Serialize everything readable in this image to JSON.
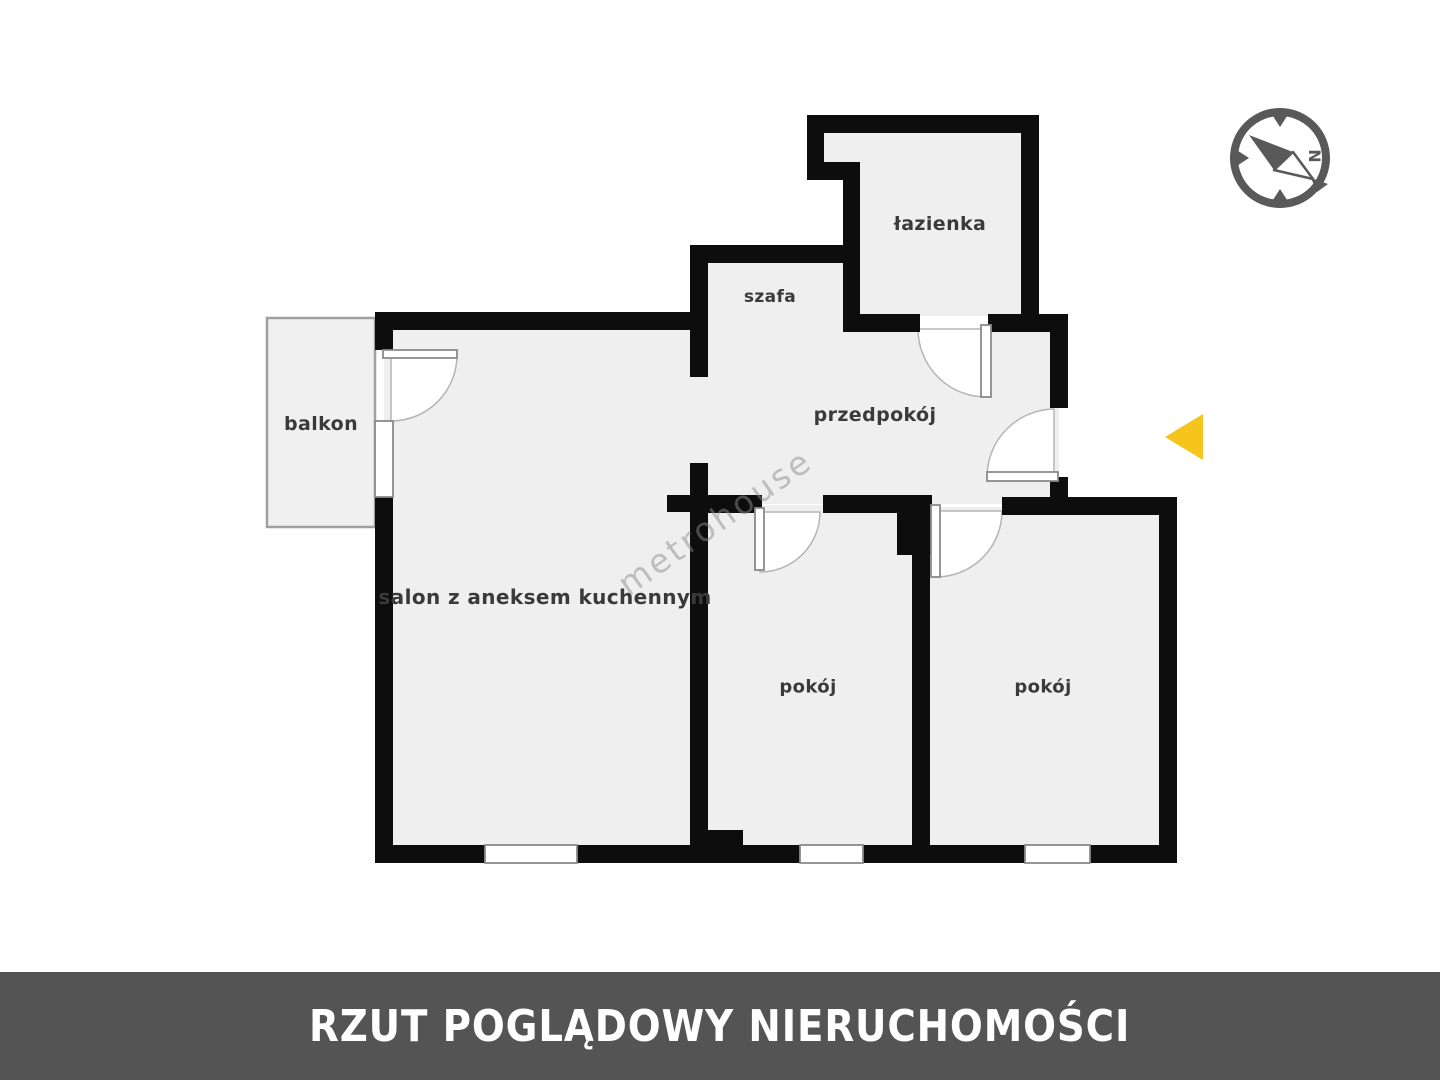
{
  "title_bar": {
    "label": "RZUT POGLĄDOWY NIERUCHOMOŚCI"
  },
  "watermark": {
    "label": "metrohouse"
  },
  "compass": {
    "north_label": "N"
  },
  "rooms": {
    "balkon": {
      "label": "balkon"
    },
    "salon": {
      "label": "salon z aneksem kuchennym"
    },
    "szafa": {
      "label": "szafa"
    },
    "przedpokoj": {
      "label": "przedpokój"
    },
    "lazienka": {
      "label": "łazienka"
    },
    "pokoj_1": {
      "label": "pokój"
    },
    "pokoj_2": {
      "label": "pokój"
    }
  },
  "colors": {
    "wall": "#0d0d0d",
    "room_fill": "#efefef",
    "balcony_fill": "#f0f0f0",
    "accent_yellow": "#f5c41d",
    "footer_bg": "#545454",
    "footer_text": "#ffffff",
    "compass_gray": "#595959",
    "label_text": "#3a3a3a",
    "door_line": "#9a9a9a"
  }
}
